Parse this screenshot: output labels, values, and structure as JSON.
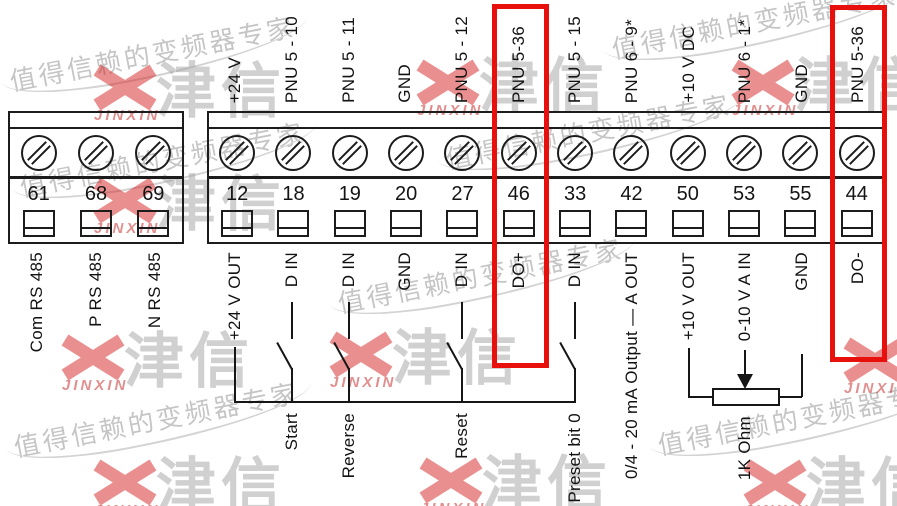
{
  "watermark": {
    "slogan": "值得信赖的变频器专家",
    "logo_cn": "津信",
    "logo_en": "JINXIN"
  },
  "left_terminals": [
    {
      "num": "61",
      "bottom": "Com RS 485"
    },
    {
      "num": "68",
      "bottom": "P RS 485"
    },
    {
      "num": "69",
      "bottom": "N RS 485"
    }
  ],
  "right_terminals": [
    {
      "num": "12",
      "top": "+24 V",
      "bottom": "+24 V OUT"
    },
    {
      "num": "18",
      "top": "PNU 5 - 10",
      "bottom": "D IN",
      "switch": "Start"
    },
    {
      "num": "19",
      "top": "PNU 5 - 11",
      "bottom": "D IN",
      "switch": "Reverse"
    },
    {
      "num": "20",
      "top": "GND",
      "bottom": "GND"
    },
    {
      "num": "27",
      "top": "PNU 5 - 12",
      "bottom": "D IN",
      "switch": "Reset"
    },
    {
      "num": "46",
      "top": "PNU 5-36",
      "bottom": "DO+",
      "highlighted": true
    },
    {
      "num": "33",
      "top": "PNU 5 - 15",
      "bottom": "D IN",
      "switch": "Preset bit 0"
    },
    {
      "num": "42",
      "top": "PNU 6 - 9*",
      "bottom": "0/4 - 20 mA Output — A OUT"
    },
    {
      "num": "50",
      "top": "+10 V DC",
      "bottom": "+10 V OUT"
    },
    {
      "num": "53",
      "top": "PNU 6 - 1*",
      "bottom": "0-10 V A IN"
    },
    {
      "num": "55",
      "top": "GND",
      "bottom": "GND"
    },
    {
      "num": "44",
      "top": "PNU 5-36",
      "bottom": "DO-",
      "highlighted": true
    }
  ],
  "potentiometer": {
    "label": "1K Ohm"
  },
  "highlight_color": "#e8100c"
}
